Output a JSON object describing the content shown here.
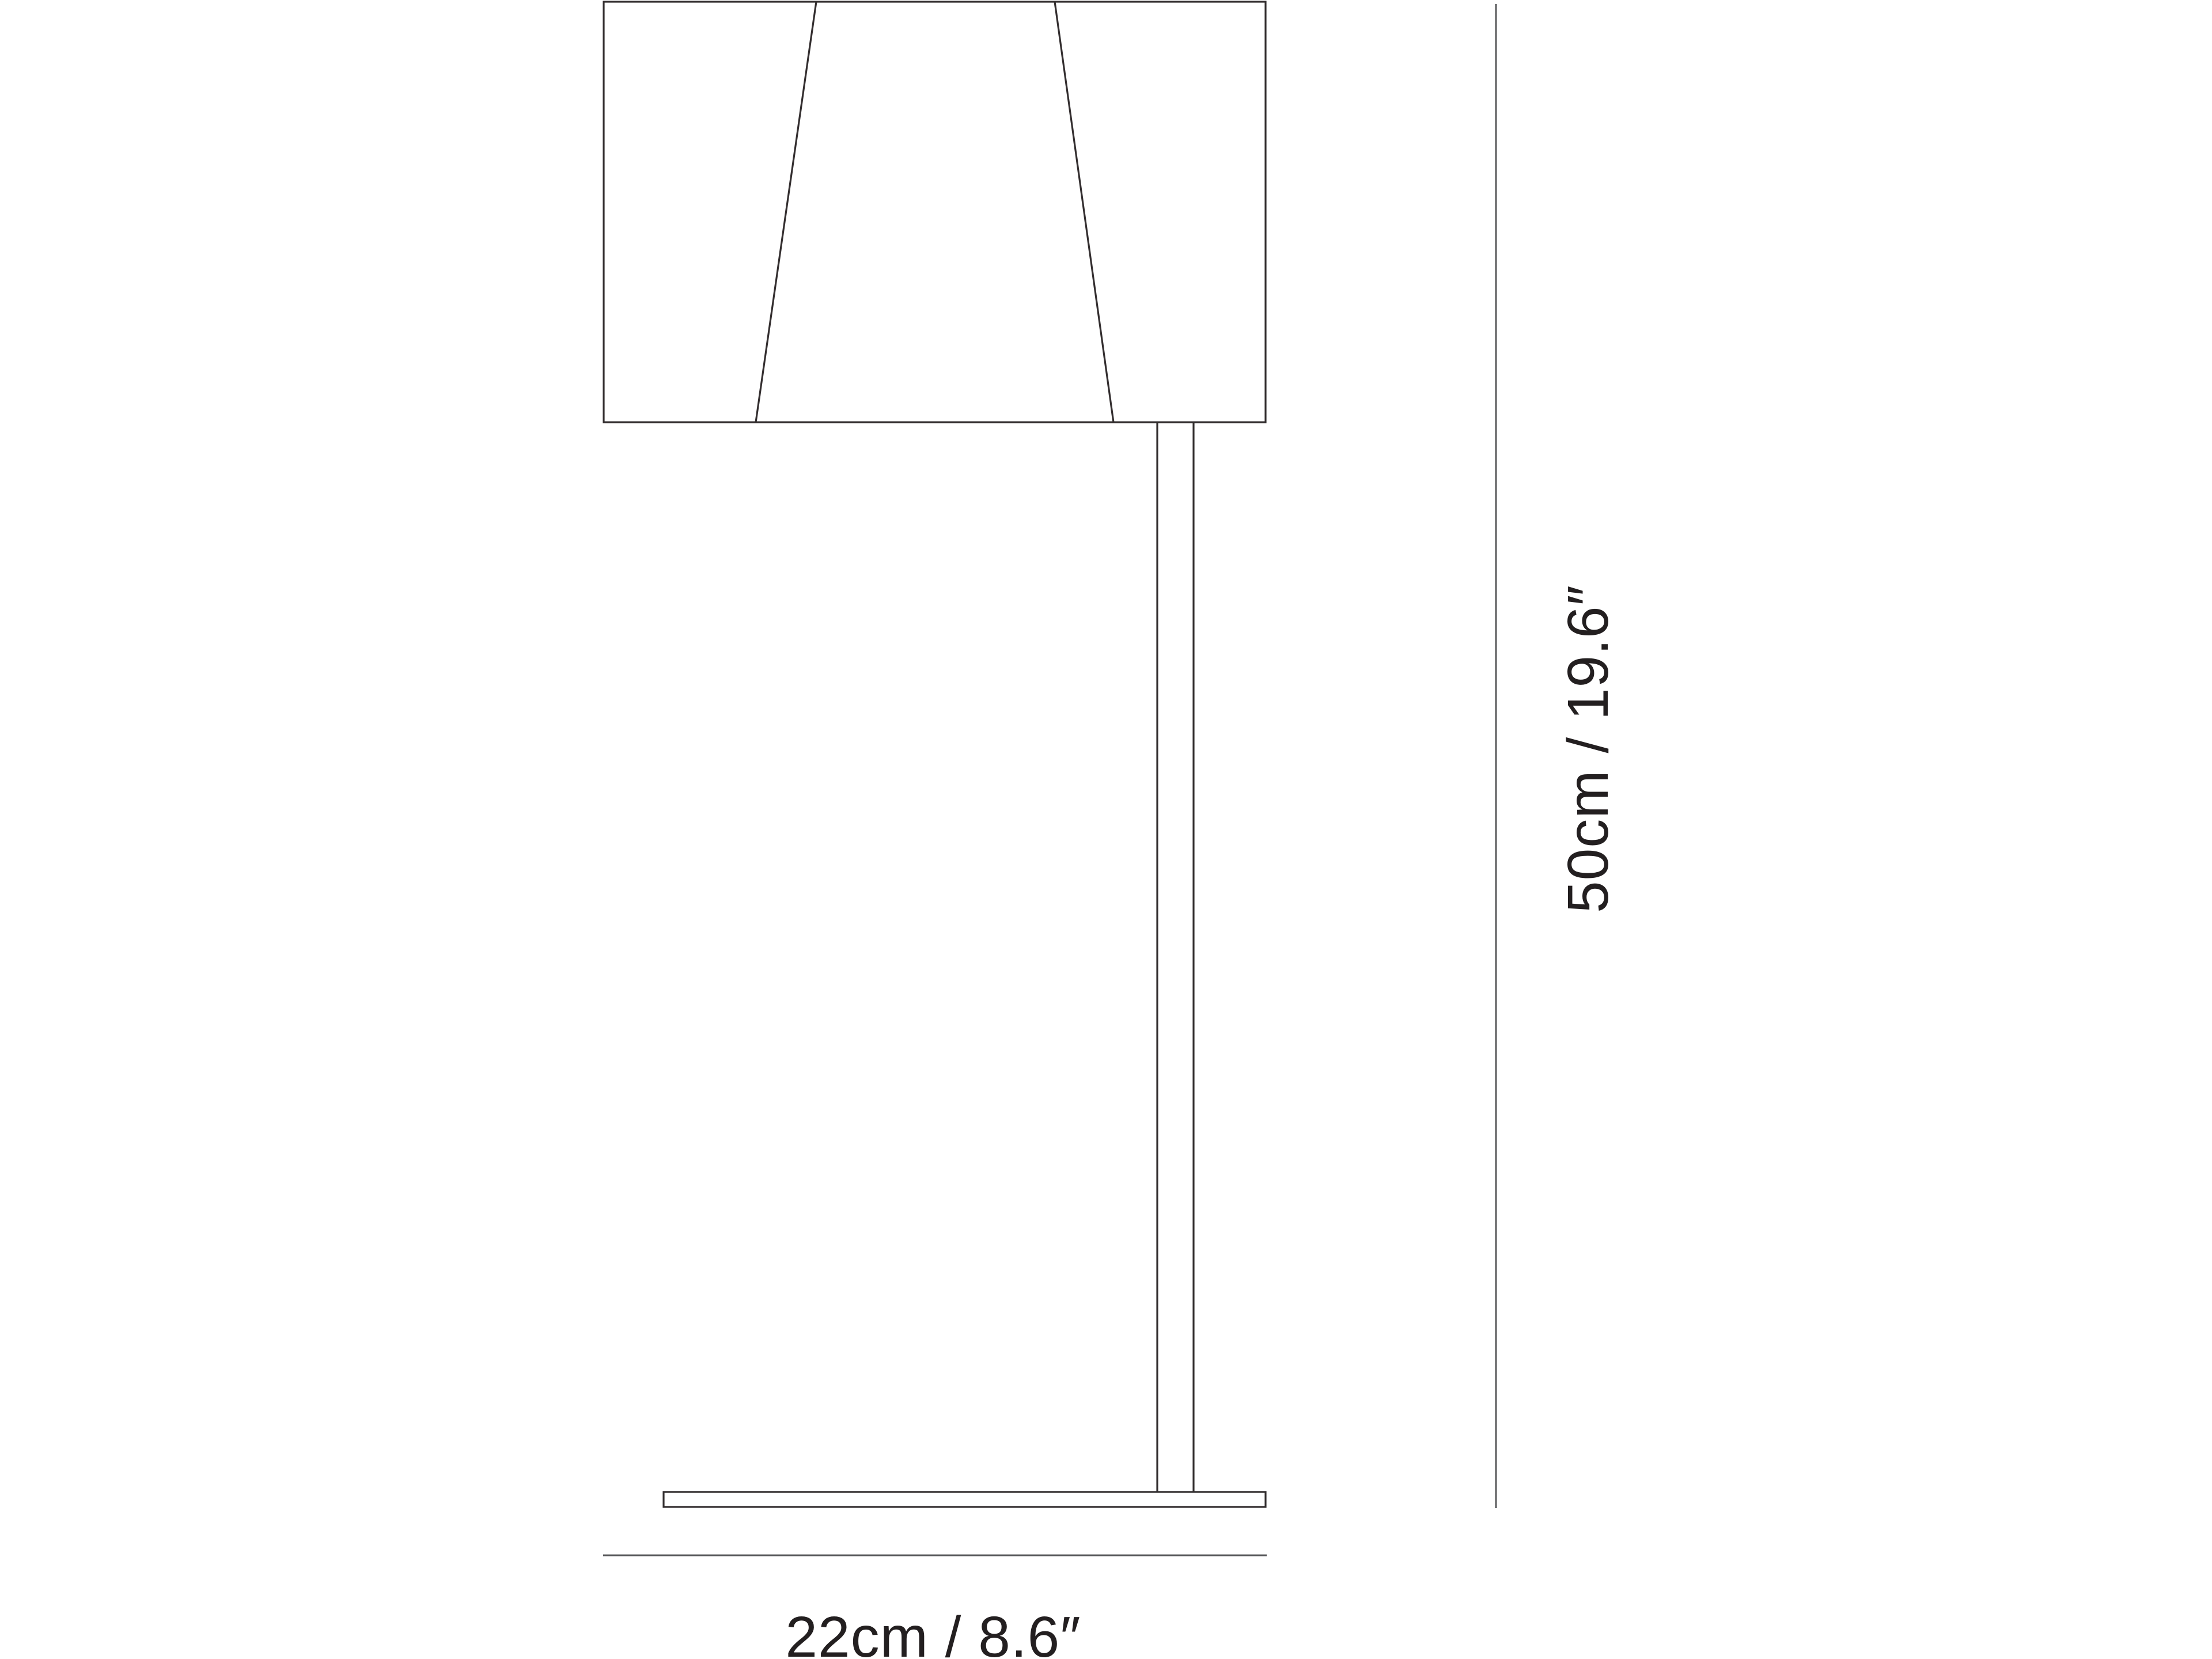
{
  "figure": {
    "type": "product-dimension-diagram",
    "subject": "table lamp line drawing",
    "height_dimension": {
      "label": "50cm / 19.6″",
      "cm": 50,
      "inches": 19.6
    },
    "width_dimension": {
      "label": "22cm / 8.6″",
      "cm": 22,
      "inches": 8.6
    }
  },
  "colors": {
    "background": "#ffffff",
    "drawing_outline": "#332e2f",
    "dimension_line": "#58595b",
    "label_text": "#231f20"
  }
}
